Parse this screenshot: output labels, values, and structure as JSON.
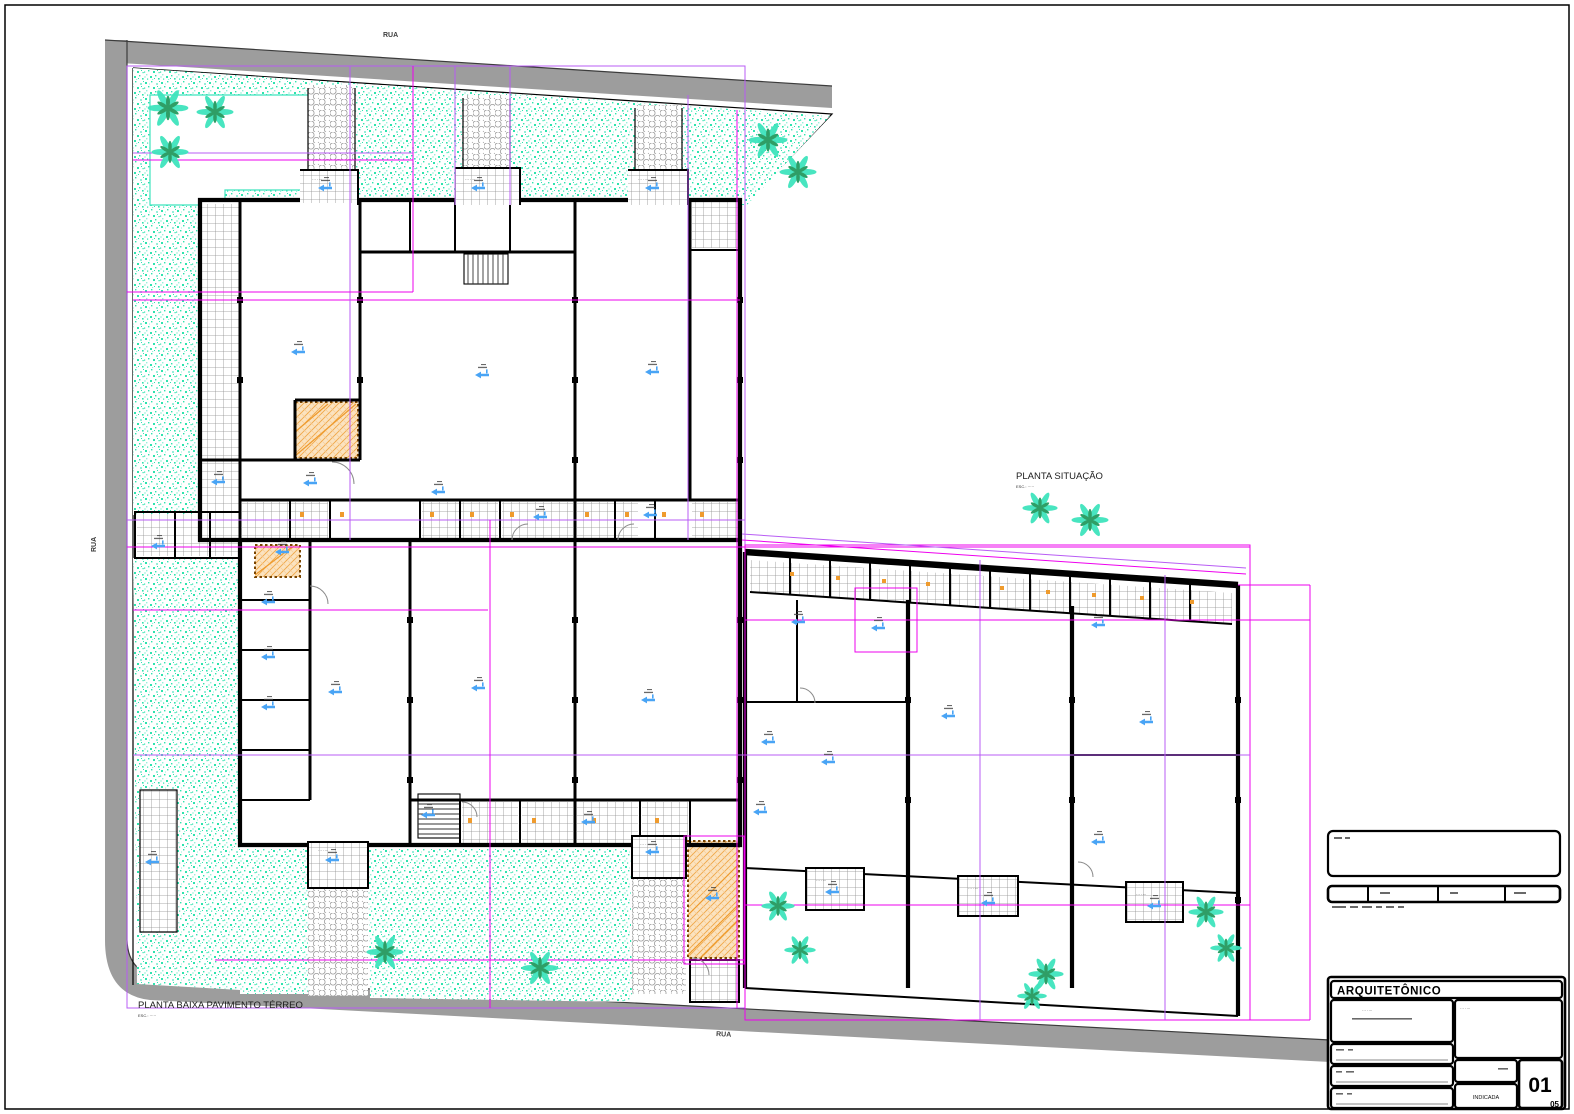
{
  "streets": {
    "label": "RUA"
  },
  "floor_plan": {
    "title": "PLANTA BAIXA PAVIMENTO TÉRREO",
    "scale_note": "ESC.: ·····"
  },
  "site_plan": {
    "title": "PLANTA SITUAÇÃO",
    "scale_note": "ESC.: ·····"
  },
  "title_block": {
    "header": "ARQUITETÔNICO",
    "scale_value": "INDICADA",
    "sheet_number": "01",
    "sheet_total": "05"
  },
  "tiny_label": "··· ····",
  "colors": {
    "road": "#9d9d9d",
    "roadedge": "#3c3c3c",
    "wall": "#000000",
    "grass1": "#2fe3ae",
    "grass2": "#96efd9",
    "palm1": "#3fe4bd",
    "palm2": "#2f9e66",
    "magenta": "#ee00ee",
    "violet": "#b85cf4",
    "orange3": "#ef9b2d",
    "orange4": "#7a4500",
    "blue": "#49a4f5",
    "tileline": "#8f8f8f",
    "honeyline": "#9a9a9a",
    "ink": "#222222"
  }
}
